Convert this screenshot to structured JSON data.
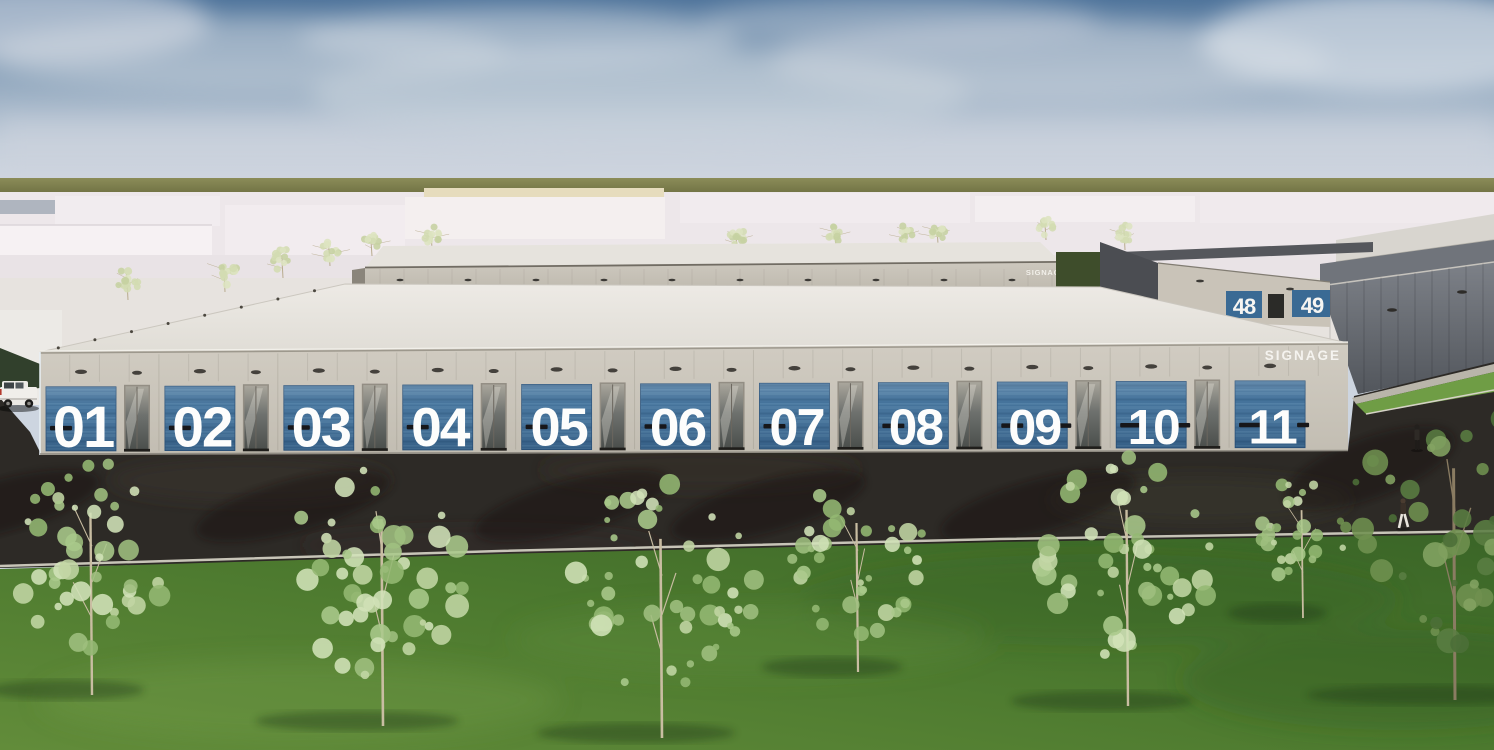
{
  "page": {
    "description": "Architectural exterior visualisation of an industrial / trade-park building with numbered units"
  },
  "main_building": {
    "signage_label": "SIGNAGE",
    "units": [
      "01",
      "02",
      "03",
      "04",
      "05",
      "06",
      "07",
      "08",
      "09",
      "10",
      "11"
    ]
  },
  "rear_building": {
    "signage_label": "SIGNAGE"
  },
  "far_building": {
    "unit_left": "48",
    "unit_right": "49"
  },
  "palette": {
    "sky_top": "#4f749b",
    "sky_horizon": "#d6dbe3",
    "olive_band": "#7c7d4b",
    "massing_white": "#f2edef",
    "facade_beige": "#c8c3b9",
    "roof_white": "#e8e5e0",
    "door_blue": "#3d6d97",
    "number_white": "#fdfdfc",
    "dark_cladding": "#5a5e64",
    "asphalt": "#2d2a26",
    "grass": "#4e7a31",
    "tree_foliage": "#b7cf97"
  }
}
